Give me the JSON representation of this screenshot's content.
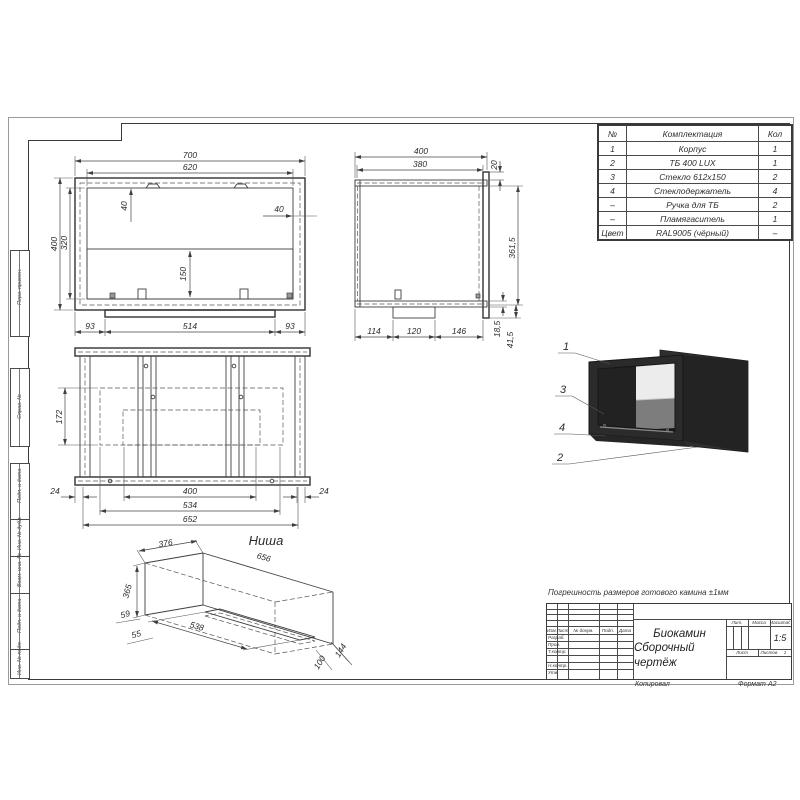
{
  "sheet": {
    "note": "Погрешность размеров готового камина ±1мм",
    "copied": "Копировал",
    "format_label": "Формат",
    "format_value": "А2"
  },
  "margin_labels": [
    "Перв. примен.",
    "Справ. №",
    "Подп. и дата",
    "Инв. № дубл.",
    "Взам. инв. №",
    "Подп. и дата",
    "Инв. № подл."
  ],
  "parts_table": {
    "col_num": "№",
    "col_name": "Комплектация",
    "col_qty": "Кол",
    "rows": [
      {
        "num": "1",
        "name": "Корпус",
        "qty": "1"
      },
      {
        "num": "2",
        "name": "ТБ 400 LUX",
        "qty": "1"
      },
      {
        "num": "3",
        "name": "Стекло 612х150",
        "qty": "2"
      },
      {
        "num": "4",
        "name": "Стеклодержатель",
        "qty": "4"
      },
      {
        "num": "–",
        "name": "Ручка для ТБ",
        "qty": "2"
      },
      {
        "num": "–",
        "name": "Пламягаситель",
        "qty": "1"
      },
      {
        "num": "Цвет",
        "name": "RAL9005 (чёрный)",
        "qty": "–"
      }
    ]
  },
  "title_block": {
    "title_line1": "Биокамин",
    "title_line2": "Сборочный чертёж",
    "lit": "Лит.",
    "mass": "Масса",
    "scale": "Масштаб",
    "scale_value": "1:5",
    "sheet": "Лист",
    "sheets": "Листов",
    "sheets_value": "1",
    "hdr_izm": "Изм.",
    "hdr_list": "Лист",
    "hdr_doc": "№ докум.",
    "hdr_sign": "Подп.",
    "hdr_date": "Дата",
    "r1": "Разраб.",
    "r2": "Пров.",
    "r3": "Т.контр.",
    "r4": "Н.контр.",
    "r5": "Утв."
  },
  "views": {
    "front": {
      "d700": "700",
      "d620": "620",
      "d400": "400",
      "d320": "320",
      "d40t": "40",
      "d40r": "40",
      "d150": "150",
      "d93l": "93",
      "d514": "514",
      "d93r": "93"
    },
    "side": {
      "d400": "400",
      "d380": "380",
      "d20": "20",
      "d3615": "361,5",
      "d114": "114",
      "d120": "120",
      "d146": "146",
      "d185": "18,5",
      "d415": "41,5"
    },
    "top": {
      "d172": "172",
      "d24l": "24",
      "d24r": "24",
      "d400": "400",
      "d534": "534",
      "d652": "652"
    },
    "niche": {
      "label": "Ниша",
      "d376": "376",
      "d656": "656",
      "d365": "365",
      "d59": "59",
      "d55": "55",
      "d538": "538",
      "d100": "100",
      "d144": "144"
    },
    "render": {
      "c1": "1",
      "c2": "2",
      "c3": "3",
      "c4": "4"
    }
  },
  "colors": {
    "line": "#3f3f3f",
    "body_dark": "#2b2b2b",
    "glass": "#8f8f8f"
  }
}
